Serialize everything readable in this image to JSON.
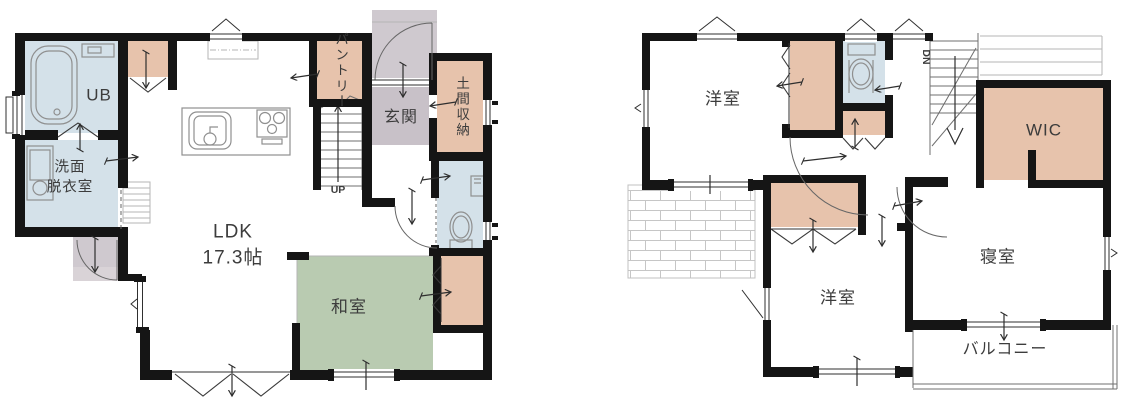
{
  "colors": {
    "wall": "#151515",
    "wet_area": "#d4e1e9",
    "storage": "#e7c3ac",
    "tatami": "#b9cbb1",
    "entrance_floor": "#c8c1c8",
    "porch": "#cfc9cf",
    "porch_step": "#d9d3d7",
    "label_text": "#3c3c3c"
  },
  "floor1": {
    "rooms": {
      "unit_bath": "UB",
      "washroom_line1": "洗面",
      "washroom_line2": "脱衣室",
      "ldk_line1": "LDK",
      "ldk_line2": "17.3帖",
      "pantry": "パントリー",
      "entrance": "玄関",
      "entrance_storage": "土間収納",
      "japanese_room": "和室"
    },
    "stairs_label": "UP"
  },
  "floor2": {
    "rooms": {
      "western_room_upper": "洋室",
      "walk_in_closet": "WIC",
      "western_room_lower": "洋室",
      "main_bedroom": "寝室",
      "balcony": "バルコニー"
    },
    "stairs_label": "DN"
  }
}
